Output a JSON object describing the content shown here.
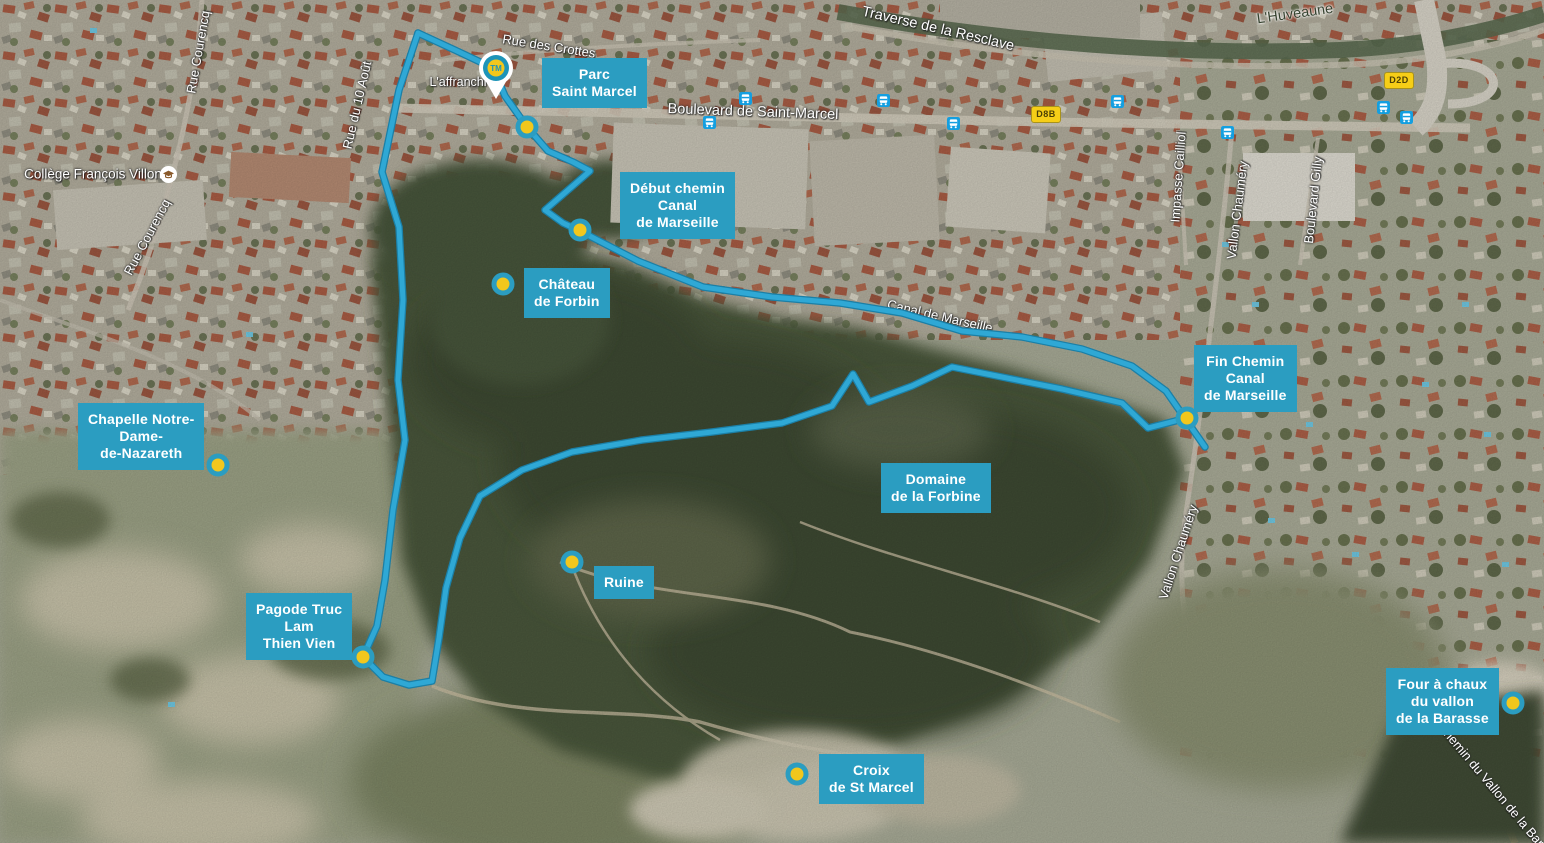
{
  "map": {
    "start_marker": {
      "label": "TM"
    },
    "waypoints": [
      {
        "label": "Parc\nSaint Marcel"
      },
      {
        "label": "Début chemin\nCanal\nde Marseille"
      },
      {
        "label": "Château\nde Forbin"
      },
      {
        "label": "Fin Chemin\nCanal\nde Marseille"
      },
      {
        "label": "Chapelle Notre-\nDame-\nde-Nazareth"
      },
      {
        "label": "Domaine\nde la Forbine"
      },
      {
        "label": "Ruine"
      },
      {
        "label": "Pagode Truc\nLam\nThien Vien"
      },
      {
        "label": "Croix\nde St Marcel"
      },
      {
        "label": "Four à chaux\ndu vallon\nde la Barasse"
      }
    ],
    "street_labels": [
      {
        "text": "Rue des Crottes"
      },
      {
        "text": "L'affranchi"
      },
      {
        "text": "Boulevard de Saint-Marcel"
      },
      {
        "text": "Traverse de la Resclave"
      },
      {
        "text": "L'Huveaune"
      },
      {
        "text": "Collège François Villon"
      },
      {
        "text": "Rue Courencq"
      },
      {
        "text": "Rue Courencq"
      },
      {
        "text": "Rue du 10 Août"
      },
      {
        "text": "Impasse Cailliol"
      },
      {
        "text": "Vallon Chauméry"
      },
      {
        "text": "Boulevard Gilly"
      },
      {
        "text": "Vallon Chauméry"
      },
      {
        "text": "Canal de Marseille"
      },
      {
        "text": "Chemin du Vallon de la Barasse"
      }
    ],
    "road_shields": [
      {
        "text": "D2D"
      },
      {
        "text": "D8B"
      }
    ],
    "colors": {
      "label_background": "#2b9dc1",
      "marker_yellow": "#f2c71d",
      "route_blue": "#2fa8d5",
      "route_casing": "#1b7fa6",
      "bus_blue": "#149fe0",
      "shield_yellow": "#f6ce17"
    }
  }
}
